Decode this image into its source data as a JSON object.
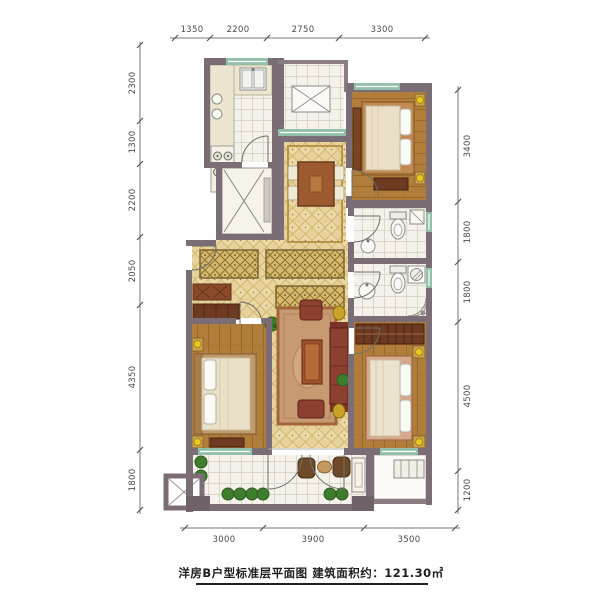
{
  "plan": {
    "caption": "洋房B户型标准层平面图 建筑面积约：121.30㎡",
    "dims": {
      "top": [
        "1350",
        "2200",
        "2750",
        "3300"
      ],
      "left": [
        "2300",
        "1300",
        "2200",
        "2050",
        "4350",
        "1800"
      ],
      "right": [
        "3400",
        "1800",
        "1800",
        "4500",
        "1200"
      ],
      "bottom": [
        "3000",
        "3900",
        "3500"
      ]
    },
    "colors": {
      "wall": "#7b6d75",
      "floor_tile": "#e6d29a",
      "floor_wood": "#b17d3b",
      "floor_white": "#f4f2eb",
      "window_sill": "#92c1a9",
      "band_tile": "#d6b96e",
      "sofa": "#8c4030",
      "wood_furniture": "#6e3a22",
      "lamp": "#ecc722",
      "plant": "#3f7d2e",
      "dimension_line": "#777777"
    }
  }
}
